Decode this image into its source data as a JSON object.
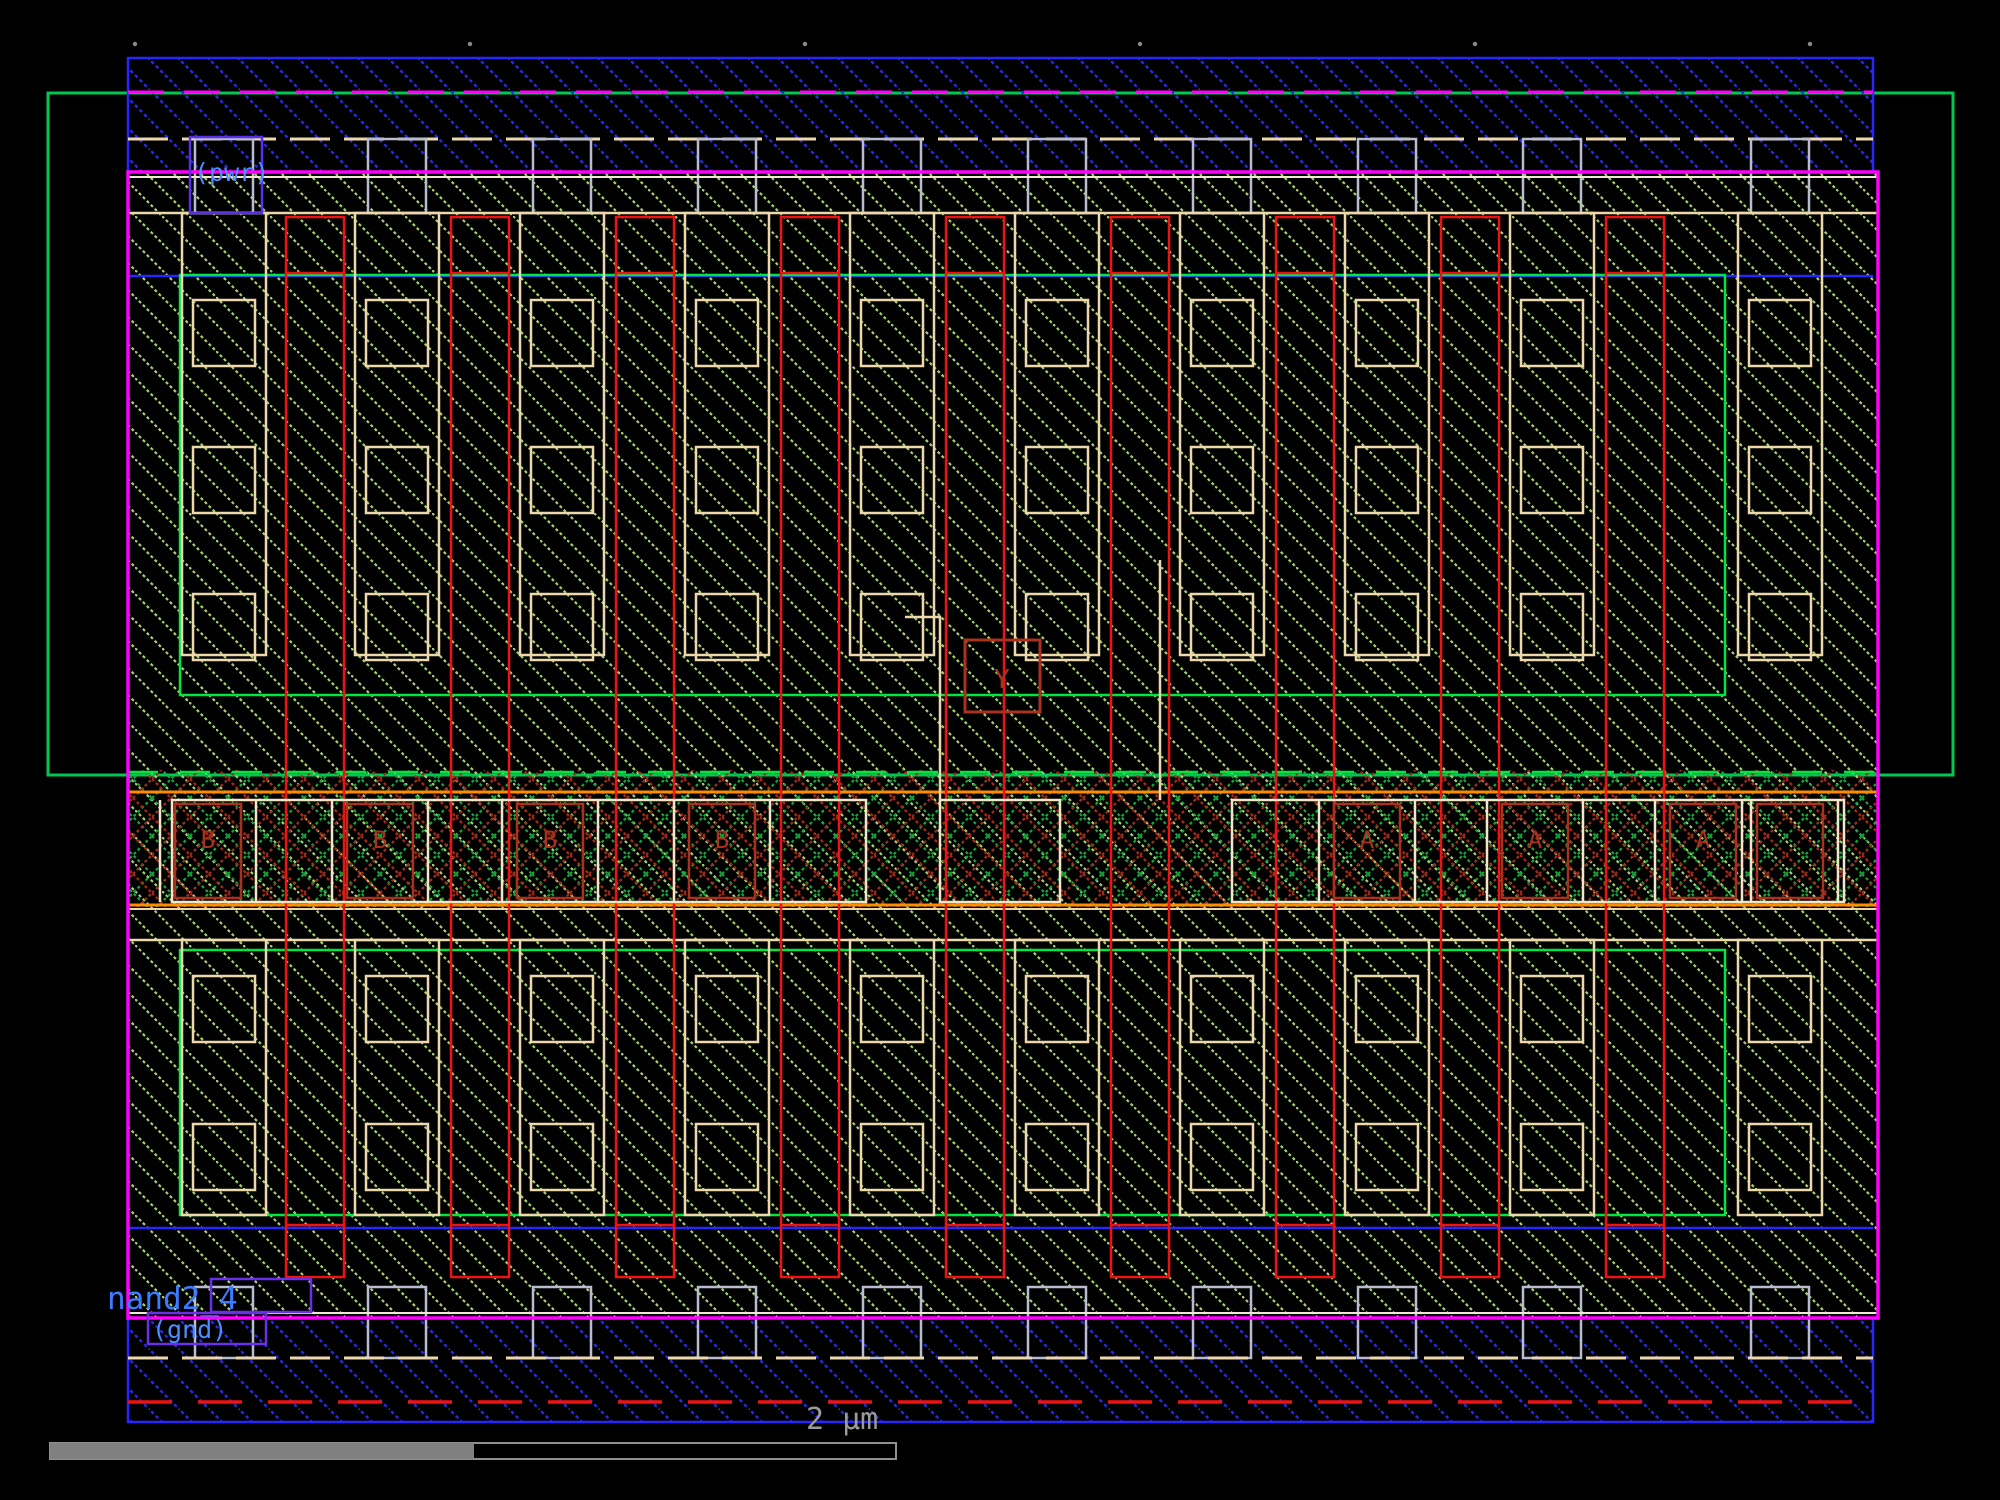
{
  "canvas": {
    "tool_view": "ic-layout-editor-canvas",
    "cell_name": "nand2_4"
  },
  "labels": {
    "cell_name": "nand2_4",
    "power": "(pwr)",
    "ground": "(gnd)"
  },
  "band": {
    "left_contacts": [
      {
        "label": "B"
      },
      {
        "label": "B"
      },
      {
        "label": "B"
      },
      {
        "label": "B"
      }
    ],
    "right_contacts": [
      {
        "label": "A"
      },
      {
        "label": "A"
      },
      {
        "label": "A"
      }
    ],
    "output": {
      "label": "Y"
    }
  },
  "scale_bar": {
    "label": "2 µm"
  },
  "colors": {
    "metal1_blue": "#2626ff",
    "poly_red": "#ee1212",
    "diffusion_olive": "#a5cf72",
    "select_green": "#00e640",
    "well_outer_green": "#00c853",
    "cell_border_magenta": "#ff00ff",
    "contact_tan": "#ecd8ab",
    "via_gray": "#b9bccf",
    "band_dark_red": "#9c2a1a",
    "band_green": "#17a339",
    "orange_rail": "#ff8c00",
    "label_blue": "#4d8dff",
    "port_box_purple": "#5a2fe8",
    "scalebar_gray": "#8a8a8a"
  }
}
